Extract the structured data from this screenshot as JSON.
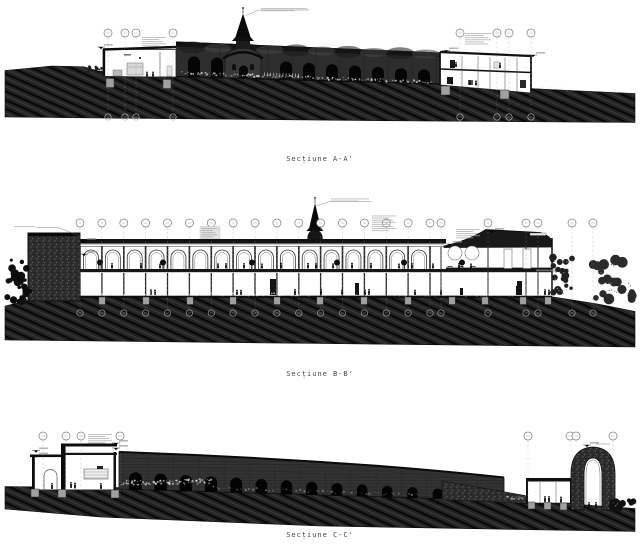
{
  "sheet": {
    "background": "#ffffff",
    "captions": {
      "a": "Secțiune A-A'",
      "b": "Secțiune B-B'",
      "c": "Secțiune C-C'"
    }
  },
  "palette": {
    "ink": "#111111",
    "ground_hatch": "#242424",
    "facade": "#2d2d2d",
    "stone_texture": "#2e2e2e",
    "bubble_stroke": "#7a7a7a",
    "annotation_gray": "#9a9a9a",
    "paper": "#ffffff"
  }
}
